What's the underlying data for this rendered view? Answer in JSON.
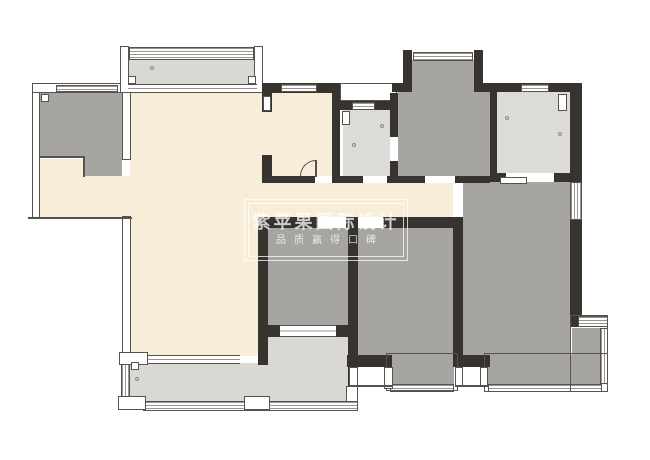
{
  "title": "apartment-floor-plan",
  "palette": {
    "wall": "#37332f",
    "line": "#57524d",
    "wline": "#9a9792",
    "cream": "#f8edd8",
    "gray": "#a7a5a2",
    "light": "#dcdbd7",
    "balc": "#d9d8d3",
    "wm": "rgba(255,255,255,0.75)"
  },
  "watermark": {
    "line1": "紫苹果国际设计",
    "line2": "品质赢得口碑"
  },
  "plan": {
    "width": 650,
    "height": 460,
    "layers": {
      "fills": [
        {
          "n": "study-room-fill-upper",
          "c": "gray",
          "x": 40,
          "y": 93,
          "w": 82,
          "h": 64
        },
        {
          "n": "study-room-fill-lower",
          "c": "gray",
          "x": 85,
          "y": 157,
          "w": 37,
          "h": 19
        },
        {
          "n": "north-balcony-fill",
          "c": "balc",
          "x": 128,
          "y": 59,
          "w": 129,
          "h": 26
        },
        {
          "n": "entry-fill-left",
          "c": "cream",
          "x": 40,
          "y": 159,
          "w": 45,
          "h": 58
        },
        {
          "n": "entry-fill-right",
          "c": "cream",
          "x": 85,
          "y": 176,
          "w": 45,
          "h": 41
        },
        {
          "n": "living-room-fill",
          "c": "cream",
          "x": 130,
          "y": 93,
          "w": 132,
          "h": 263
        },
        {
          "n": "dining-room-fill",
          "c": "cream",
          "x": 262,
          "y": 93,
          "w": 70,
          "h": 83
        },
        {
          "n": "hallway-fill",
          "c": "cream",
          "x": 262,
          "y": 183,
          "w": 200,
          "h": 34
        },
        {
          "n": "storage-room-fill",
          "c": "light",
          "x": 343,
          "y": 110,
          "w": 47,
          "h": 68
        },
        {
          "n": "bathroom-fill",
          "c": "gray",
          "x": 398,
          "y": 92,
          "w": 92,
          "h": 84
        },
        {
          "n": "bathroom-niche-fill",
          "c": "gray",
          "x": 412,
          "y": 60,
          "w": 62,
          "h": 32
        },
        {
          "n": "kitchen-fill",
          "c": "light",
          "x": 497,
          "y": 92,
          "w": 73,
          "h": 81
        },
        {
          "n": "bedroom-left-fill",
          "c": "gray",
          "x": 268,
          "y": 228,
          "w": 80,
          "h": 97
        },
        {
          "n": "bedroom-middle-fill",
          "c": "gray",
          "x": 358,
          "y": 228,
          "w": 95,
          "h": 127
        },
        {
          "n": "master-bedroom-fill",
          "c": "gray",
          "x": 462,
          "y": 182,
          "w": 108,
          "h": 173
        },
        {
          "n": "middle-bay-window-fill",
          "c": "gray",
          "x": 390,
          "y": 355,
          "w": 64,
          "h": 29
        },
        {
          "n": "master-bay-bottom-fill",
          "c": "gray",
          "x": 488,
          "y": 355,
          "w": 112,
          "h": 29
        },
        {
          "n": "master-bay-side-fill",
          "c": "gray",
          "x": 572,
          "y": 328,
          "w": 28,
          "h": 54
        },
        {
          "n": "south-balcony-fill-main",
          "c": "balc",
          "x": 130,
          "y": 363,
          "w": 218,
          "h": 40
        },
        {
          "n": "south-balcony-fill-upper",
          "c": "balc",
          "x": 268,
          "y": 336,
          "w": 80,
          "h": 28
        }
      ],
      "structure": [
        {
          "n": "exterior-wall-left",
          "c": "tw",
          "x": 32,
          "y": 83,
          "w": 8,
          "h": 136
        },
        {
          "n": "exterior-wall-top-left",
          "c": "tw",
          "x": 32,
          "y": 83,
          "w": 91,
          "h": 10
        },
        {
          "n": "study-right-wall",
          "c": "tw",
          "x": 122,
          "y": 90,
          "w": 9,
          "h": 70
        },
        {
          "n": "exterior-wall-lower-left",
          "c": "tw",
          "x": 122,
          "y": 216,
          "w": 9,
          "h": 141
        },
        {
          "n": "north-balcony-pillar-left",
          "c": "tw",
          "x": 120,
          "y": 46,
          "w": 9,
          "h": 47
        },
        {
          "n": "north-balcony-pillar-right",
          "c": "tw",
          "x": 254,
          "y": 46,
          "w": 9,
          "h": 47
        },
        {
          "n": "storage-top-recess",
          "c": "tw",
          "x": 340,
          "y": 83,
          "w": 57,
          "h": 18
        }
      ],
      "walls": [
        {
          "n": "wall-dining-top",
          "c": "wall",
          "x": 262,
          "y": 83,
          "w": 78,
          "h": 10
        },
        {
          "n": "wall-dining-left-upper",
          "c": "wall",
          "x": 262,
          "y": 93,
          "w": 10,
          "h": 19
        },
        {
          "n": "wall-dining-left-lower",
          "c": "wall",
          "x": 262,
          "y": 155,
          "w": 10,
          "h": 21
        },
        {
          "n": "wall-dining-bottom",
          "c": "wall",
          "x": 262,
          "y": 176,
          "w": 70,
          "h": 7
        },
        {
          "n": "wall-dining-right",
          "c": "wall",
          "x": 332,
          "y": 83,
          "w": 8,
          "h": 93
        },
        {
          "n": "wall-storage-top",
          "c": "wall",
          "x": 340,
          "y": 101,
          "w": 58,
          "h": 9
        },
        {
          "n": "wall-storage-right-upper",
          "c": "wall",
          "x": 390,
          "y": 93,
          "w": 8,
          "h": 44
        },
        {
          "n": "wall-storage-right-lower",
          "c": "wall",
          "x": 390,
          "y": 161,
          "w": 8,
          "h": 22
        },
        {
          "n": "wall-storage-bottom",
          "c": "wall",
          "x": 332,
          "y": 176,
          "w": 66,
          "h": 7
        },
        {
          "n": "wall-niche-left",
          "c": "wall",
          "x": 403,
          "y": 50,
          "w": 9,
          "h": 42
        },
        {
          "n": "wall-niche-right",
          "c": "wall",
          "x": 474,
          "y": 50,
          "w": 9,
          "h": 42
        },
        {
          "n": "wall-top-mid-stub",
          "c": "wall",
          "x": 392,
          "y": 83,
          "w": 11,
          "h": 9
        },
        {
          "n": "wall-top-right",
          "c": "wall",
          "x": 483,
          "y": 83,
          "w": 99,
          "h": 9
        },
        {
          "n": "wall-bathroom-right",
          "c": "wall",
          "x": 490,
          "y": 92,
          "w": 7,
          "h": 84
        },
        {
          "n": "wall-bathroom-bottom",
          "c": "wall",
          "x": 392,
          "y": 176,
          "w": 98,
          "h": 7
        },
        {
          "n": "wall-kitchen-bottom",
          "c": "wall",
          "x": 490,
          "y": 173,
          "w": 92,
          "h": 9
        },
        {
          "n": "wall-kitchen-right",
          "c": "wall",
          "x": 570,
          "y": 92,
          "w": 12,
          "h": 81
        },
        {
          "n": "wall-master-right",
          "c": "wall",
          "x": 570,
          "y": 220,
          "w": 12,
          "h": 107
        },
        {
          "n": "wall-hall-bottom-left",
          "c": "wall",
          "x": 262,
          "y": 217,
          "w": 56,
          "h": 11
        },
        {
          "n": "wall-hall-bottom-mid",
          "c": "wall",
          "x": 346,
          "y": 217,
          "w": 12,
          "h": 11
        },
        {
          "n": "wall-hall-bottom-right",
          "c": "wall",
          "x": 383,
          "y": 217,
          "w": 80,
          "h": 11
        },
        {
          "n": "wall-bedrooms-divider",
          "c": "wall",
          "x": 348,
          "y": 228,
          "w": 10,
          "h": 99
        },
        {
          "n": "wall-balcony-right",
          "c": "wall",
          "x": 348,
          "y": 327,
          "w": 10,
          "h": 62
        },
        {
          "n": "wall-bedroom-left-west",
          "c": "wall",
          "x": 258,
          "y": 217,
          "w": 10,
          "h": 148
        },
        {
          "n": "wall-bedroom-left-stub-a",
          "c": "wall",
          "x": 268,
          "y": 325,
          "w": 12,
          "h": 12
        },
        {
          "n": "wall-bedroom-left-stub-b",
          "c": "wall",
          "x": 336,
          "y": 325,
          "w": 12,
          "h": 12
        },
        {
          "n": "wall-bedroom-middle-bottom",
          "c": "wall",
          "x": 347,
          "y": 355,
          "w": 45,
          "h": 12
        },
        {
          "n": "wall-master-left",
          "c": "wall",
          "x": 453,
          "y": 217,
          "w": 10,
          "h": 150
        },
        {
          "n": "wall-master-bottom",
          "c": "wall",
          "x": 462,
          "y": 355,
          "w": 28,
          "h": 12
        },
        {
          "n": "line-entry-bottom",
          "c": "ln",
          "x": 28,
          "y": 217,
          "w": 104,
          "h": 2
        },
        {
          "n": "line-study-notch-h",
          "c": "ln",
          "x": 40,
          "y": 156,
          "w": 45,
          "h": 2
        },
        {
          "n": "line-study-notch-v",
          "c": "ln",
          "x": 83,
          "y": 156,
          "w": 2,
          "h": 21
        }
      ],
      "openings": [
        {
          "n": "window-study-top",
          "c": "win-h",
          "x": 56,
          "y": 85,
          "w": 62,
          "h": 7
        },
        {
          "n": "window-north-balcony",
          "c": "win-h",
          "x": 129,
          "y": 47,
          "w": 125,
          "h": 13
        },
        {
          "n": "sliding-door-north-balcony",
          "c": "sld",
          "x": 128,
          "y": 84,
          "w": 129,
          "h": 9
        },
        {
          "n": "window-dining-top",
          "c": "win-h",
          "x": 281,
          "y": 84,
          "w": 36,
          "h": 8
        },
        {
          "n": "window-storage-top",
          "c": "win-h",
          "x": 352,
          "y": 102,
          "w": 23,
          "h": 8
        },
        {
          "n": "window-niche-top",
          "c": "win-h",
          "x": 413,
          "y": 52,
          "w": 60,
          "h": 9
        },
        {
          "n": "window-kitchen-top",
          "c": "win-h",
          "x": 521,
          "y": 84,
          "w": 28,
          "h": 8
        },
        {
          "n": "window-master-right",
          "c": "win-v",
          "x": 570,
          "y": 182,
          "w": 12,
          "h": 38
        },
        {
          "n": "door-gap-dining",
          "c": "gap",
          "x": 315,
          "y": 176,
          "w": 17,
          "h": 7
        },
        {
          "n": "door-gap-storage",
          "c": "gap",
          "x": 363,
          "y": 176,
          "w": 24,
          "h": 7
        },
        {
          "n": "gap-storage-right",
          "c": "gap",
          "x": 390,
          "y": 137,
          "w": 8,
          "h": 24
        },
        {
          "n": "door-gap-bathroom",
          "c": "gap",
          "x": 425,
          "y": 176,
          "w": 30,
          "h": 7
        },
        {
          "n": "door-gap-kitchen",
          "c": "gap",
          "x": 506,
          "y": 173,
          "w": 48,
          "h": 9
        },
        {
          "n": "kitchen-sliding-leaf",
          "c": "sym",
          "x": 500,
          "y": 177,
          "w": 27,
          "h": 7
        },
        {
          "n": "door-gap-hall-a",
          "c": "gap",
          "x": 318,
          "y": 217,
          "w": 28,
          "h": 11
        },
        {
          "n": "door-gap-hall-b",
          "c": "gap",
          "x": 358,
          "y": 217,
          "w": 25,
          "h": 11
        },
        {
          "n": "door-gap-master",
          "c": "gap",
          "x": 453,
          "y": 183,
          "w": 10,
          "h": 34
        },
        {
          "n": "sliding-door-bedroom-left",
          "c": "sld",
          "x": 280,
          "y": 325,
          "w": 56,
          "h": 12
        },
        {
          "n": "sliding-door-living-balcony",
          "c": "sld",
          "x": 148,
          "y": 355,
          "w": 92,
          "h": 9
        },
        {
          "n": "window-balcony-left",
          "c": "win-v",
          "x": 121,
          "y": 364,
          "w": 9,
          "h": 34
        },
        {
          "n": "window-balcony-bottom",
          "c": "win-h",
          "x": 143,
          "y": 401,
          "w": 215,
          "h": 10
        },
        {
          "n": "window-middle-bay",
          "c": "win-h",
          "x": 390,
          "y": 384,
          "w": 64,
          "h": 8
        },
        {
          "n": "window-master-bay-bottom",
          "c": "win-h",
          "x": 488,
          "y": 384,
          "w": 114,
          "h": 8
        },
        {
          "n": "window-master-bay-side",
          "c": "win-v",
          "x": 600,
          "y": 328,
          "w": 8,
          "h": 56
        },
        {
          "n": "window-master-bay-top",
          "c": "win-h",
          "x": 578,
          "y": 316,
          "w": 30,
          "h": 11
        }
      ],
      "overlays": [
        {
          "n": "frame-middle-bay",
          "c": "frame",
          "x": 386,
          "y": 353,
          "w": 72,
          "h": 38
        },
        {
          "n": "frame-master-bay-bottom",
          "c": "frame",
          "x": 484,
          "y": 353,
          "w": 124,
          "h": 39
        },
        {
          "n": "frame-master-bay-side",
          "c": "frame",
          "x": 570,
          "y": 315,
          "w": 38,
          "h": 77
        },
        {
          "n": "balcony-pillar-top-left",
          "c": "sym",
          "x": 119,
          "y": 352,
          "w": 29,
          "h": 13
        },
        {
          "n": "balcony-pillar-bottom-left",
          "c": "sym",
          "x": 118,
          "y": 396,
          "w": 28,
          "h": 14
        },
        {
          "n": "balcony-pillar-mid",
          "c": "sym",
          "x": 244,
          "y": 396,
          "w": 26,
          "h": 14
        },
        {
          "n": "balcony-pillar-right",
          "c": "sym",
          "x": 346,
          "y": 386,
          "w": 12,
          "h": 16
        },
        {
          "n": "bay-gap-pillar-a",
          "c": "sym",
          "x": 349,
          "y": 367,
          "w": 9,
          "h": 20
        },
        {
          "n": "bay-gap-pillar-b",
          "c": "sym",
          "x": 384,
          "y": 367,
          "w": 9,
          "h": 22
        },
        {
          "n": "bay-gap-line-a",
          "c": "ln",
          "x": 349,
          "y": 385,
          "w": 44,
          "h": 2
        },
        {
          "n": "bay-gap-pillar-c",
          "c": "sym",
          "x": 455,
          "y": 367,
          "w": 8,
          "h": 20
        },
        {
          "n": "bay-gap-pillar-d",
          "c": "sym",
          "x": 480,
          "y": 367,
          "w": 8,
          "h": 20
        },
        {
          "n": "bay-gap-line-b",
          "c": "ln",
          "x": 455,
          "y": 385,
          "w": 33,
          "h": 2
        },
        {
          "n": "study-corner-symbol",
          "c": "sym",
          "x": 41,
          "y": 94,
          "w": 8,
          "h": 8
        },
        {
          "n": "storage-door-symbol",
          "c": "sym",
          "x": 342,
          "y": 111,
          "w": 8,
          "h": 14
        },
        {
          "n": "kitchen-corner-symbol",
          "c": "sym",
          "x": 558,
          "y": 94,
          "w": 9,
          "h": 17
        },
        {
          "n": "north-balcony-corner-left",
          "c": "sym",
          "x": 128,
          "y": 76,
          "w": 8,
          "h": 8
        },
        {
          "n": "north-balcony-corner-right",
          "c": "sym",
          "x": 248,
          "y": 76,
          "w": 8,
          "h": 8
        },
        {
          "n": "dining-door-leaf-symbol",
          "c": "sym",
          "x": 263,
          "y": 96,
          "w": 8,
          "h": 15
        },
        {
          "n": "balcony-corner-symbol",
          "c": "sym",
          "x": 131,
          "y": 362,
          "w": 8,
          "h": 8
        },
        {
          "n": "dining-door-arc",
          "c": "arc",
          "x": 300,
          "y": 160,
          "w": 16,
          "h": 16
        },
        {
          "n": "dining-door-leaf",
          "c": "ln",
          "x": 315,
          "y": 160,
          "w": 2,
          "h": 17
        },
        {
          "n": "marker-dot-balcony",
          "c": "dot",
          "x": 150,
          "y": 66,
          "w": 4,
          "h": 4
        },
        {
          "n": "marker-dot-kitchen-a",
          "c": "dot",
          "x": 505,
          "y": 116,
          "w": 4,
          "h": 4
        },
        {
          "n": "marker-dot-kitchen-b",
          "c": "dot",
          "x": 558,
          "y": 132,
          "w": 4,
          "h": 4
        },
        {
          "n": "marker-dot-storage-a",
          "c": "dot",
          "x": 380,
          "y": 124,
          "w": 4,
          "h": 4
        },
        {
          "n": "marker-dot-storage-b",
          "c": "dot",
          "x": 352,
          "y": 143,
          "w": 4,
          "h": 4
        },
        {
          "n": "marker-dot-south-balcony",
          "c": "dot",
          "x": 135,
          "y": 377,
          "w": 4,
          "h": 4
        }
      ]
    }
  }
}
